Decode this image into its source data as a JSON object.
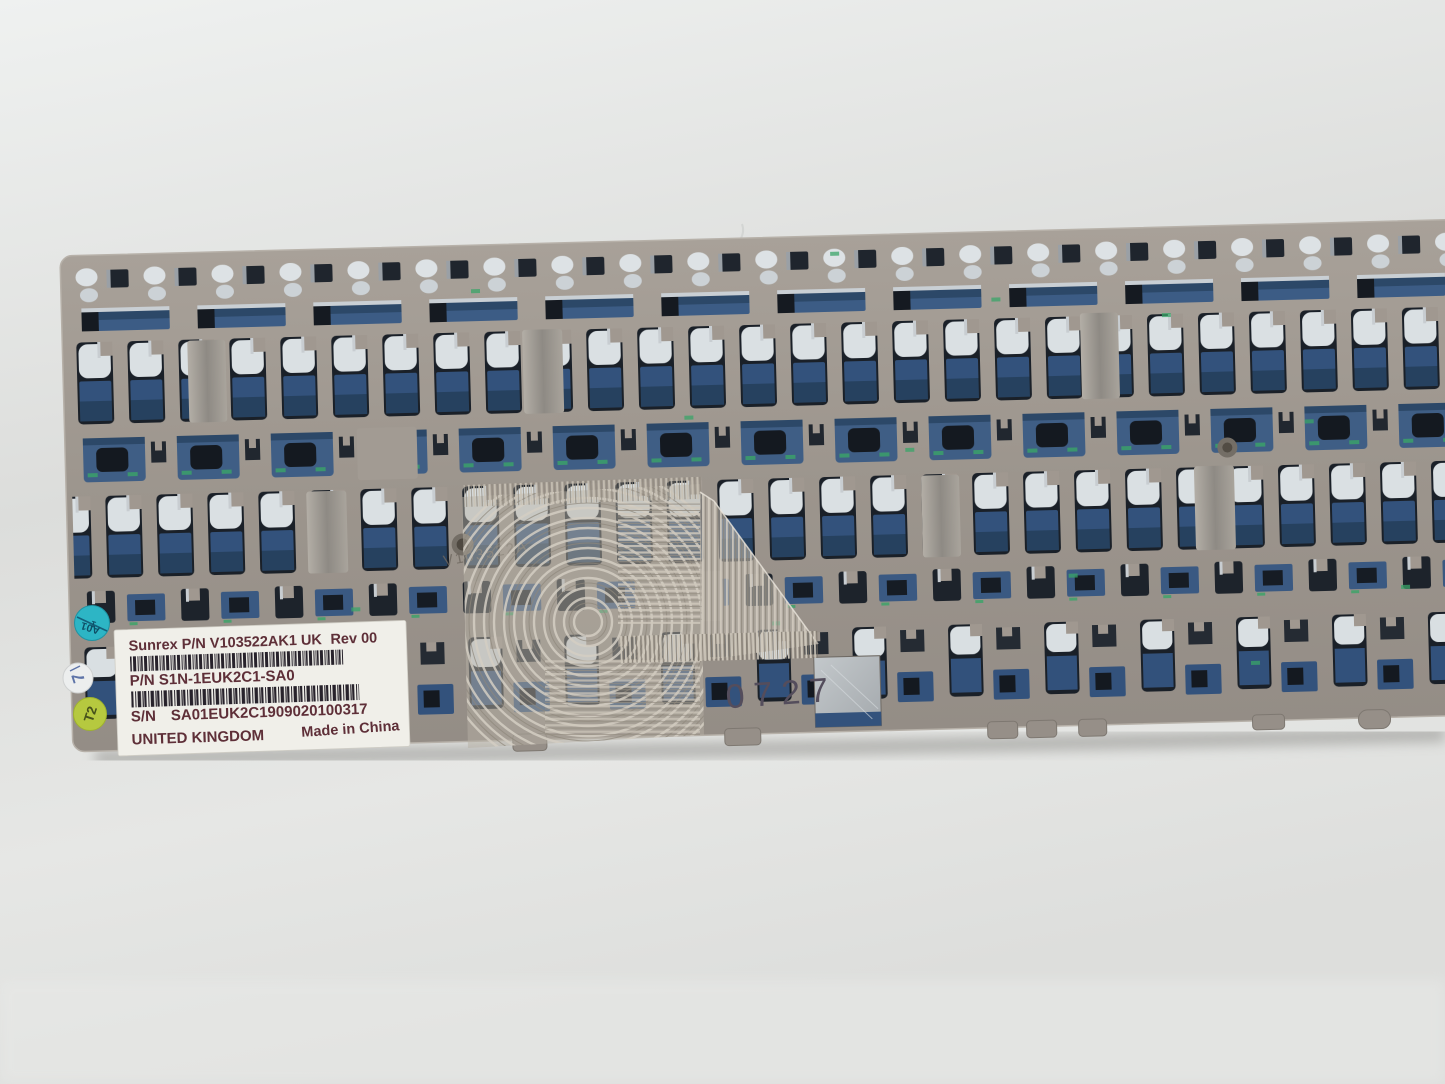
{
  "photo": {
    "description": "keyboard-backplate-photo",
    "label": {
      "line1_left": "Sunrex P/N V103522AK1 UK",
      "line1_right": "Rev 00",
      "line2": "P/N S1N-1EUK2C1-SA0",
      "line3_left": "S/N",
      "line3_right": "SA01EUK2C1909020100317",
      "line4_left": "UNITED KINGDOM",
      "line4_right": "Made in China"
    },
    "stamp": "0727",
    "etched_text": "V103522A",
    "stickers": {
      "teal_top": "A01",
      "teal_bottom": "1",
      "white": "7",
      "green": "T2"
    },
    "colors": {
      "background": "#e3e5e3",
      "plate": "#a09890",
      "membrane_blue": "#3f5e85",
      "cutout_dark": "#1a2028",
      "silver": "#dae0e3",
      "trace_green": "#3aa468",
      "label_bg": "#f0efe9",
      "label_text": "#5e2f38",
      "barcode": "#2a242c",
      "sticker_teal": "#2db5c5",
      "sticker_white": "#eceeee",
      "sticker_green": "#b6c93f",
      "stamp_color": "#544d5c"
    }
  }
}
